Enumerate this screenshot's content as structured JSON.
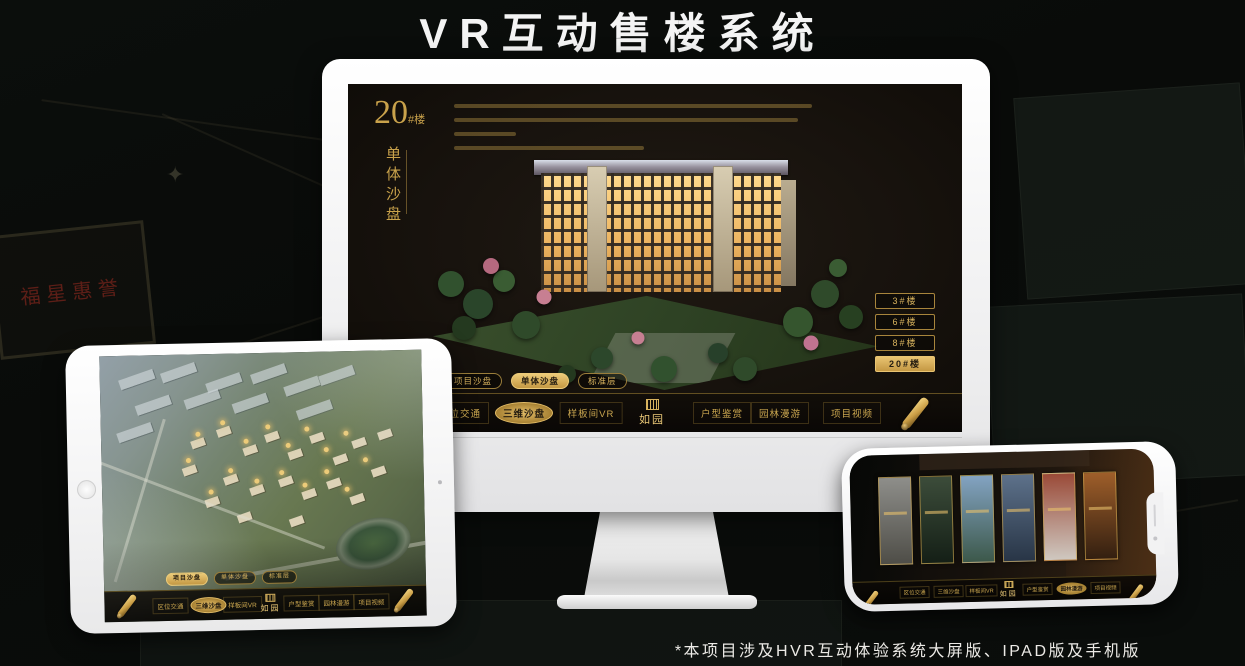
{
  "title": "VR互动售楼系统",
  "footnote": "*本项目涉及HVR互动体验系统大屏版、IPAD版及手机版",
  "colors": {
    "gold": "#c9a24b",
    "gold_bright": "#e8c06a",
    "screen_bg": "#17120d"
  },
  "background": {
    "plaque_text": "福星惠誉",
    "compass_icon": "✦"
  },
  "brand": {
    "logo_name": "如园"
  },
  "monitor": {
    "block_label": {
      "number": "20",
      "suffix": "#楼",
      "subtitle": "单体沙盘"
    },
    "floor_buttons": [
      {
        "label": "3#楼",
        "active": false
      },
      {
        "label": "6#楼",
        "active": false
      },
      {
        "label": "8#楼",
        "active": false
      },
      {
        "label": "20#楼",
        "active": true
      }
    ],
    "sub_tabs": [
      {
        "label": "项目沙盘",
        "active": false
      },
      {
        "label": "单体沙盘",
        "active": true
      },
      {
        "label": "标准层",
        "active": false
      }
    ],
    "nav_items": [
      {
        "label": "区位交通",
        "active": false
      },
      {
        "label": "三维沙盘",
        "active": true
      },
      {
        "label": "样板间VR",
        "active": false
      },
      {
        "label": "户型鉴赏",
        "active": false
      },
      {
        "label": "园林漫游",
        "active": false
      },
      {
        "label": "项目视频",
        "active": false
      }
    ],
    "logo": "如园"
  },
  "tablet": {
    "sub_tabs": [
      {
        "label": "项目沙盘",
        "active": true
      },
      {
        "label": "单体沙盘",
        "active": false
      },
      {
        "label": "标准层",
        "active": false
      }
    ],
    "nav_items": [
      {
        "label": "区位交通",
        "active": false
      },
      {
        "label": "三维沙盘",
        "active": true
      },
      {
        "label": "样板间VR",
        "active": false
      },
      {
        "label": "户型鉴赏",
        "active": false
      },
      {
        "label": "园林漫游",
        "active": false
      },
      {
        "label": "项目视频",
        "active": false
      }
    ],
    "logo": "如园"
  },
  "phone": {
    "nav_items": [
      {
        "label": "区位交通",
        "active": false
      },
      {
        "label": "三维沙盘",
        "active": false
      },
      {
        "label": "样板间VR",
        "active": false
      },
      {
        "label": "户型鉴赏",
        "active": false
      },
      {
        "label": "园林漫游",
        "active": true
      },
      {
        "label": "项目视频",
        "active": false
      }
    ],
    "logo": "如园",
    "panels": [
      {
        "name": "gate-scene",
        "colors": [
          "#8e8e8a",
          "#4e4d47"
        ]
      },
      {
        "name": "courtyard-scene",
        "colors": [
          "#3c4c3a",
          "#141f16"
        ]
      },
      {
        "name": "building-sky-scene",
        "colors": [
          "#83a3c2",
          "#3c584a"
        ]
      },
      {
        "name": "tower-scene",
        "colors": [
          "#5d718a",
          "#283546"
        ]
      },
      {
        "name": "autumn-scene",
        "colors": [
          "#9a4a38",
          "#cfc8c0"
        ]
      },
      {
        "name": "interior-scene",
        "colors": [
          "#9e5e2a",
          "#331f10"
        ]
      }
    ]
  },
  "scatter": [
    {
      "host": "building-trees",
      "class": "tree",
      "points": [
        [
          4,
          58,
          26,
          "#31512e"
        ],
        [
          10,
          66,
          30,
          "#2a452a"
        ],
        [
          16,
          57,
          22,
          "#3a5c33"
        ],
        [
          7,
          75,
          24,
          "#24391f"
        ],
        [
          21,
          74,
          28,
          "#2f4a2a"
        ],
        [
          13,
          51,
          16,
          "#b5697f"
        ],
        [
          25,
          63,
          15,
          "#c77f92"
        ],
        [
          88,
          62,
          28,
          "#2f4a2a"
        ],
        [
          94,
          71,
          24,
          "#274021"
        ],
        [
          82,
          73,
          30,
          "#35552e"
        ],
        [
          91,
          52,
          18,
          "#3a5c33"
        ],
        [
          85,
          81,
          15,
          "#bf7390"
        ],
        [
          38,
          87,
          22,
          "#2c472b"
        ],
        [
          52,
          91,
          26,
          "#31512e"
        ],
        [
          64,
          85,
          20,
          "#27402a"
        ],
        [
          46,
          79,
          13,
          "#c77f92"
        ],
        [
          70,
          91,
          24,
          "#2f4a2a"
        ],
        [
          30,
          93,
          18,
          "#24391f"
        ]
      ]
    },
    {
      "host": "tablet-industry",
      "class": "tb-ind",
      "points": [
        [
          6,
          7
        ],
        [
          19,
          5
        ],
        [
          33,
          9
        ],
        [
          47,
          6
        ],
        [
          11,
          17
        ],
        [
          26,
          15
        ],
        [
          41,
          17
        ],
        [
          57,
          11
        ],
        [
          68,
          7
        ],
        [
          5,
          27
        ],
        [
          61,
          20
        ]
      ]
    },
    {
      "host": "tablet-buildings",
      "class": "tb-bld",
      "points": [
        [
          28,
          32
        ],
        [
          36,
          28
        ],
        [
          44,
          35
        ],
        [
          51,
          30
        ],
        [
          58,
          37
        ],
        [
          65,
          31
        ],
        [
          72,
          39
        ],
        [
          78,
          33
        ],
        [
          38,
          46
        ],
        [
          46,
          50
        ],
        [
          55,
          47
        ],
        [
          62,
          52
        ],
        [
          70,
          48
        ],
        [
          32,
          54
        ],
        [
          77,
          54
        ],
        [
          84,
          44
        ],
        [
          25,
          42
        ],
        [
          86,
          30
        ],
        [
          42,
          60
        ],
        [
          58,
          62
        ]
      ]
    },
    {
      "host": "tablet-badges",
      "class": "badge-dot",
      "points": [
        [
          30,
          30,
          5,
          "#eccb79"
        ],
        [
          38,
          26,
          5,
          "#eccb79"
        ],
        [
          45,
          33,
          5,
          "#eccb79"
        ],
        [
          52,
          28,
          5,
          "#eccb79"
        ],
        [
          58,
          35,
          5,
          "#eccb79"
        ],
        [
          64,
          29,
          5,
          "#eccb79"
        ],
        [
          70,
          37,
          5,
          "#eccb79"
        ],
        [
          76,
          31,
          5,
          "#eccb79"
        ],
        [
          40,
          44,
          5,
          "#eccb79"
        ],
        [
          48,
          48,
          5,
          "#eccb79"
        ],
        [
          56,
          45,
          5,
          "#eccb79"
        ],
        [
          63,
          50,
          5,
          "#eccb79"
        ],
        [
          70,
          45,
          5,
          "#eccb79"
        ],
        [
          34,
          52,
          5,
          "#eccb79"
        ],
        [
          76,
          52,
          5,
          "#eccb79"
        ],
        [
          82,
          41,
          5,
          "#eccb79"
        ],
        [
          27,
          40,
          5,
          "#eccb79"
        ]
      ]
    }
  ]
}
